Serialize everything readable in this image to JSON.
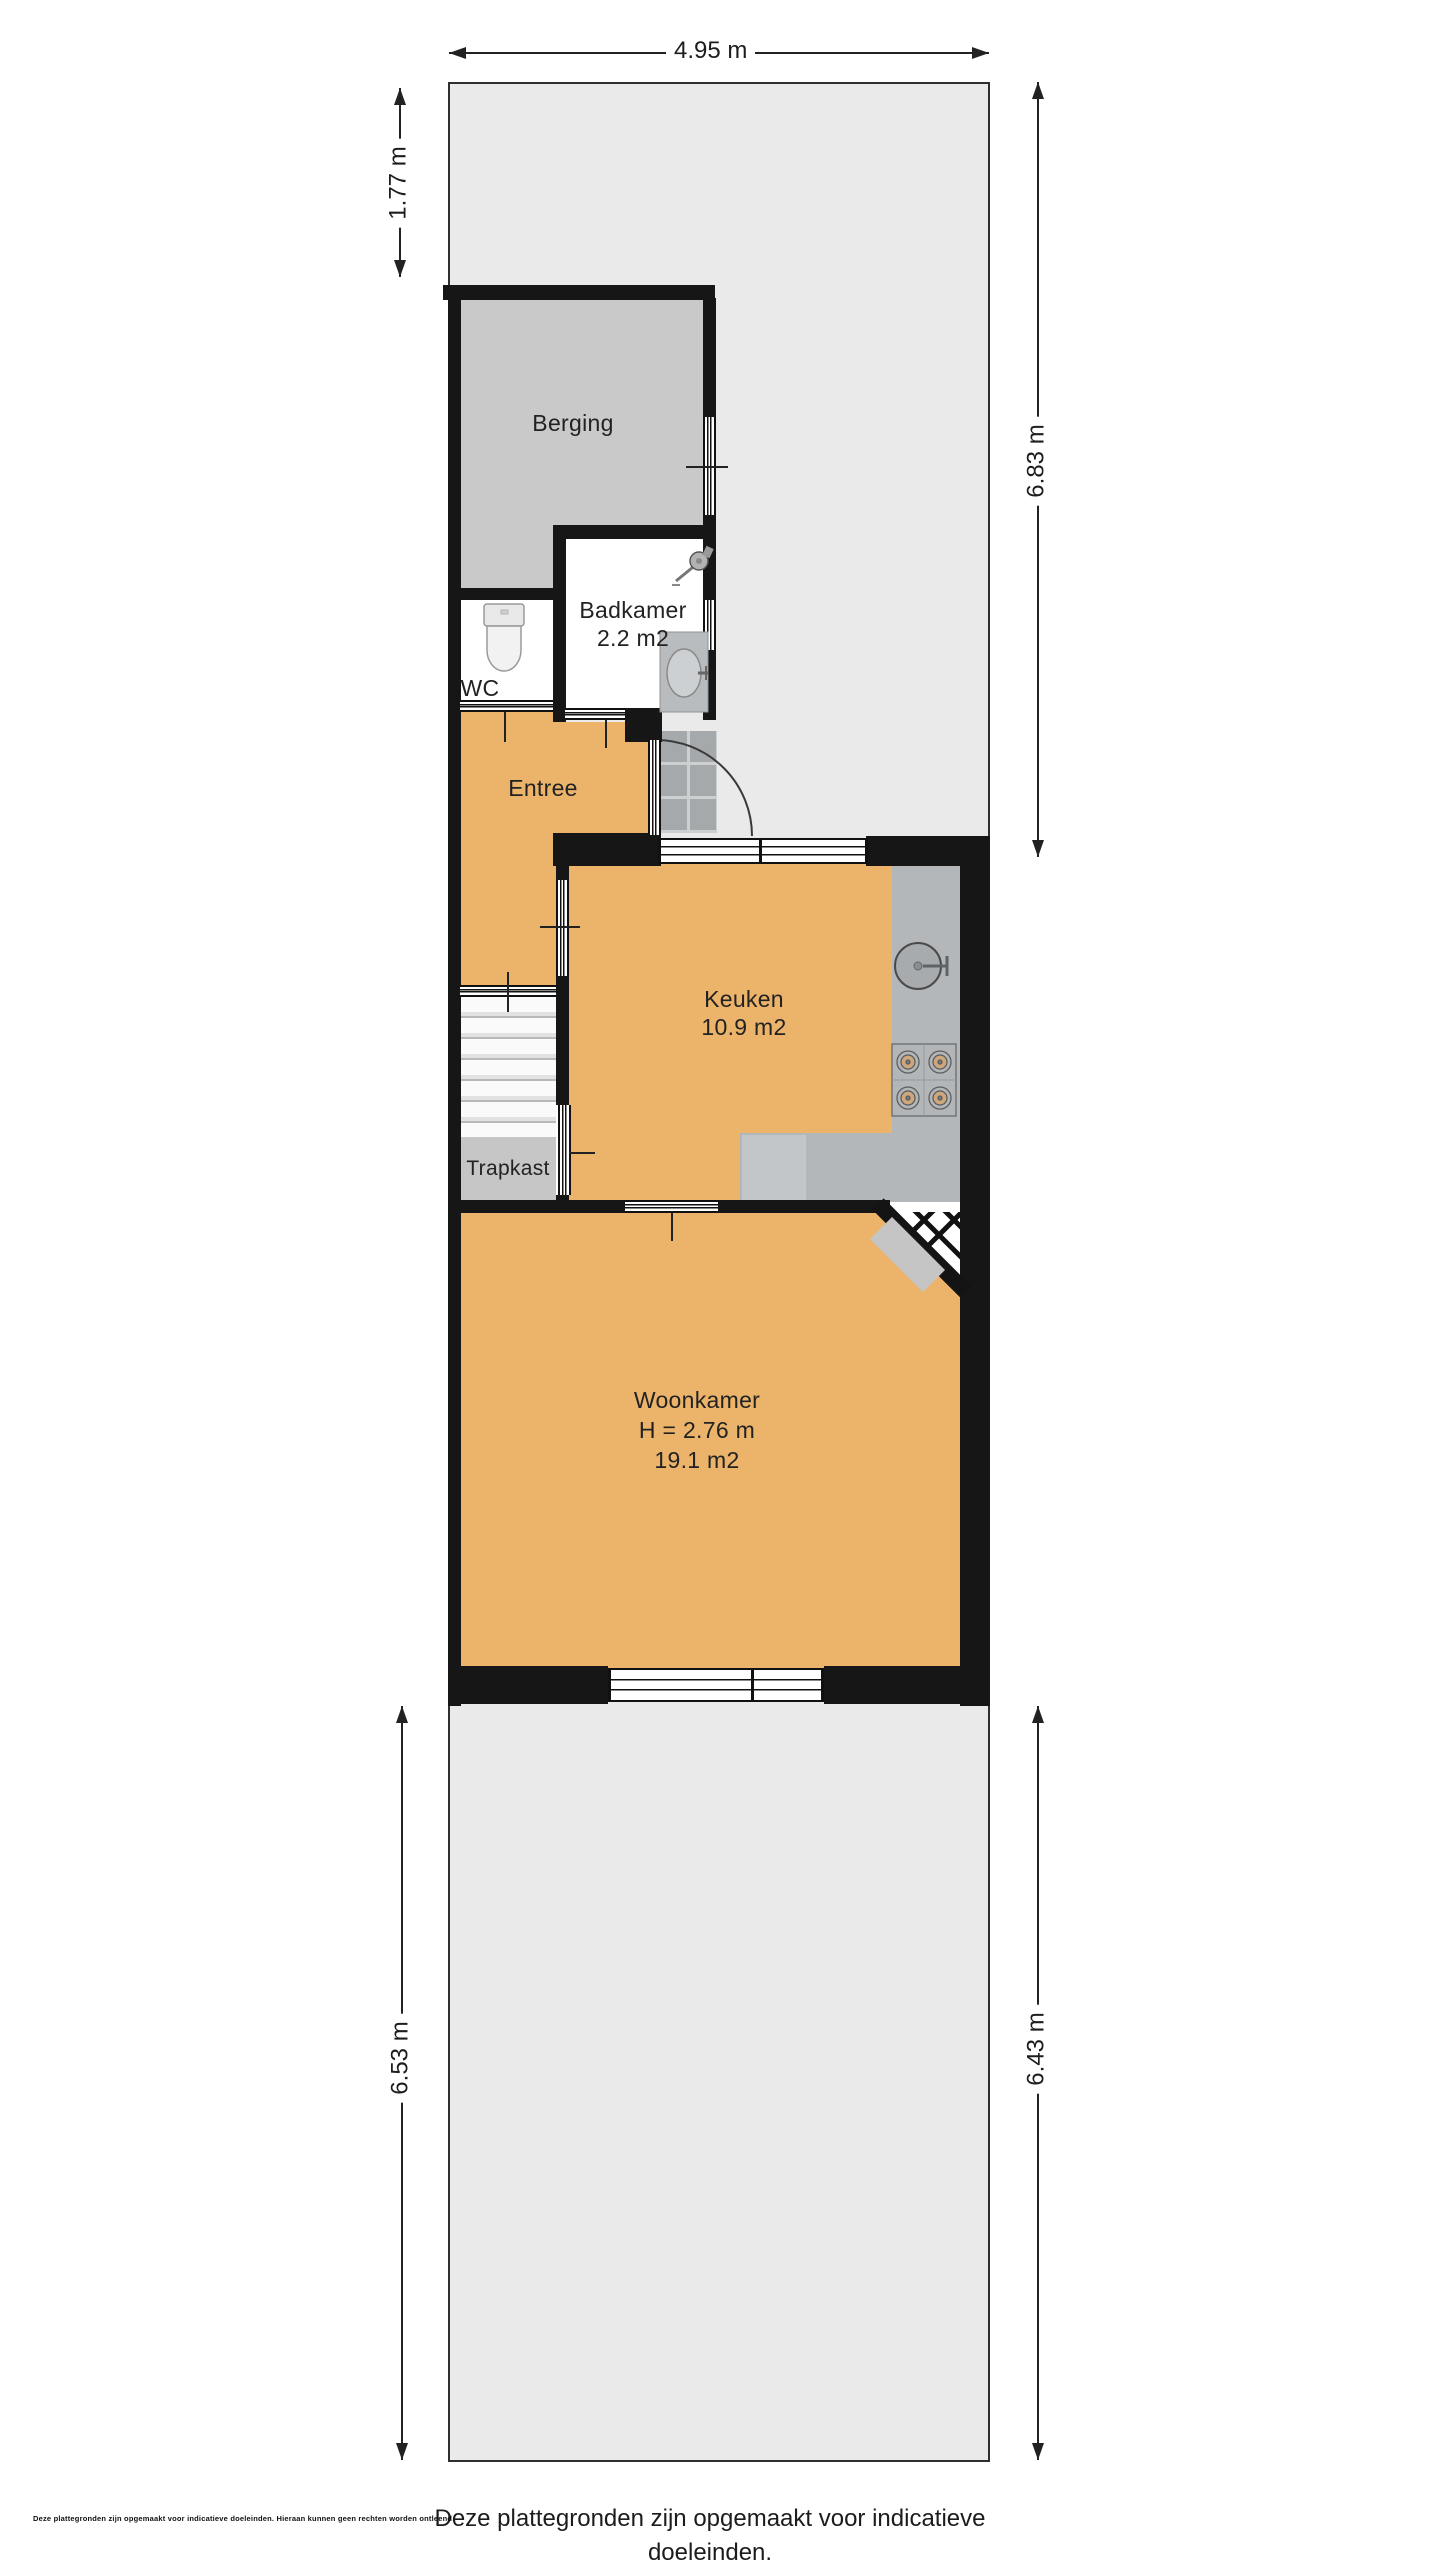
{
  "rooms": {
    "berging": {
      "label": "Berging"
    },
    "badkamer": {
      "label": "Badkamer",
      "area": "2.2 m2"
    },
    "wc": {
      "label": "WC"
    },
    "entree": {
      "label": "Entree"
    },
    "keuken": {
      "label": "Keuken",
      "area": "10.9 m2"
    },
    "trapkast": {
      "label": "Trapkast"
    },
    "woonkamer": {
      "label": "Woonkamer",
      "ceiling_height": "H = 2.76 m",
      "area": "19.1 m2"
    }
  },
  "dimensions": {
    "lot_width_top": "4.95 m",
    "front_strip_left": "1.77 m",
    "front_garden_right": "6.83 m",
    "back_garden_left": "6.53 m",
    "back_garden_right": "6.43 m"
  },
  "footer": {
    "line1": "Deze plattegronden zijn opgemaakt voor indicatieve doeleinden.",
    "line2": "Hieraan kunnen geen rechten worden ontleend",
    "fine_print": "Deze plattegronden zijn opgemaakt voor indicatieve doeleinden. Hieraan kunnen geen rechten worden ontleend"
  },
  "fixtures": [
    "toilet",
    "shower",
    "washbasin",
    "kitchen-sink",
    "stove",
    "entrance-door-swing",
    "corner-door",
    "stairs"
  ],
  "colors": {
    "room_fill": "#ecb46a",
    "storage_fill": "#c9c9c9",
    "counter_fill": "#b4b7b9",
    "garden_fill": "#eaeaea",
    "wall": "#161616",
    "text": "#222222"
  }
}
